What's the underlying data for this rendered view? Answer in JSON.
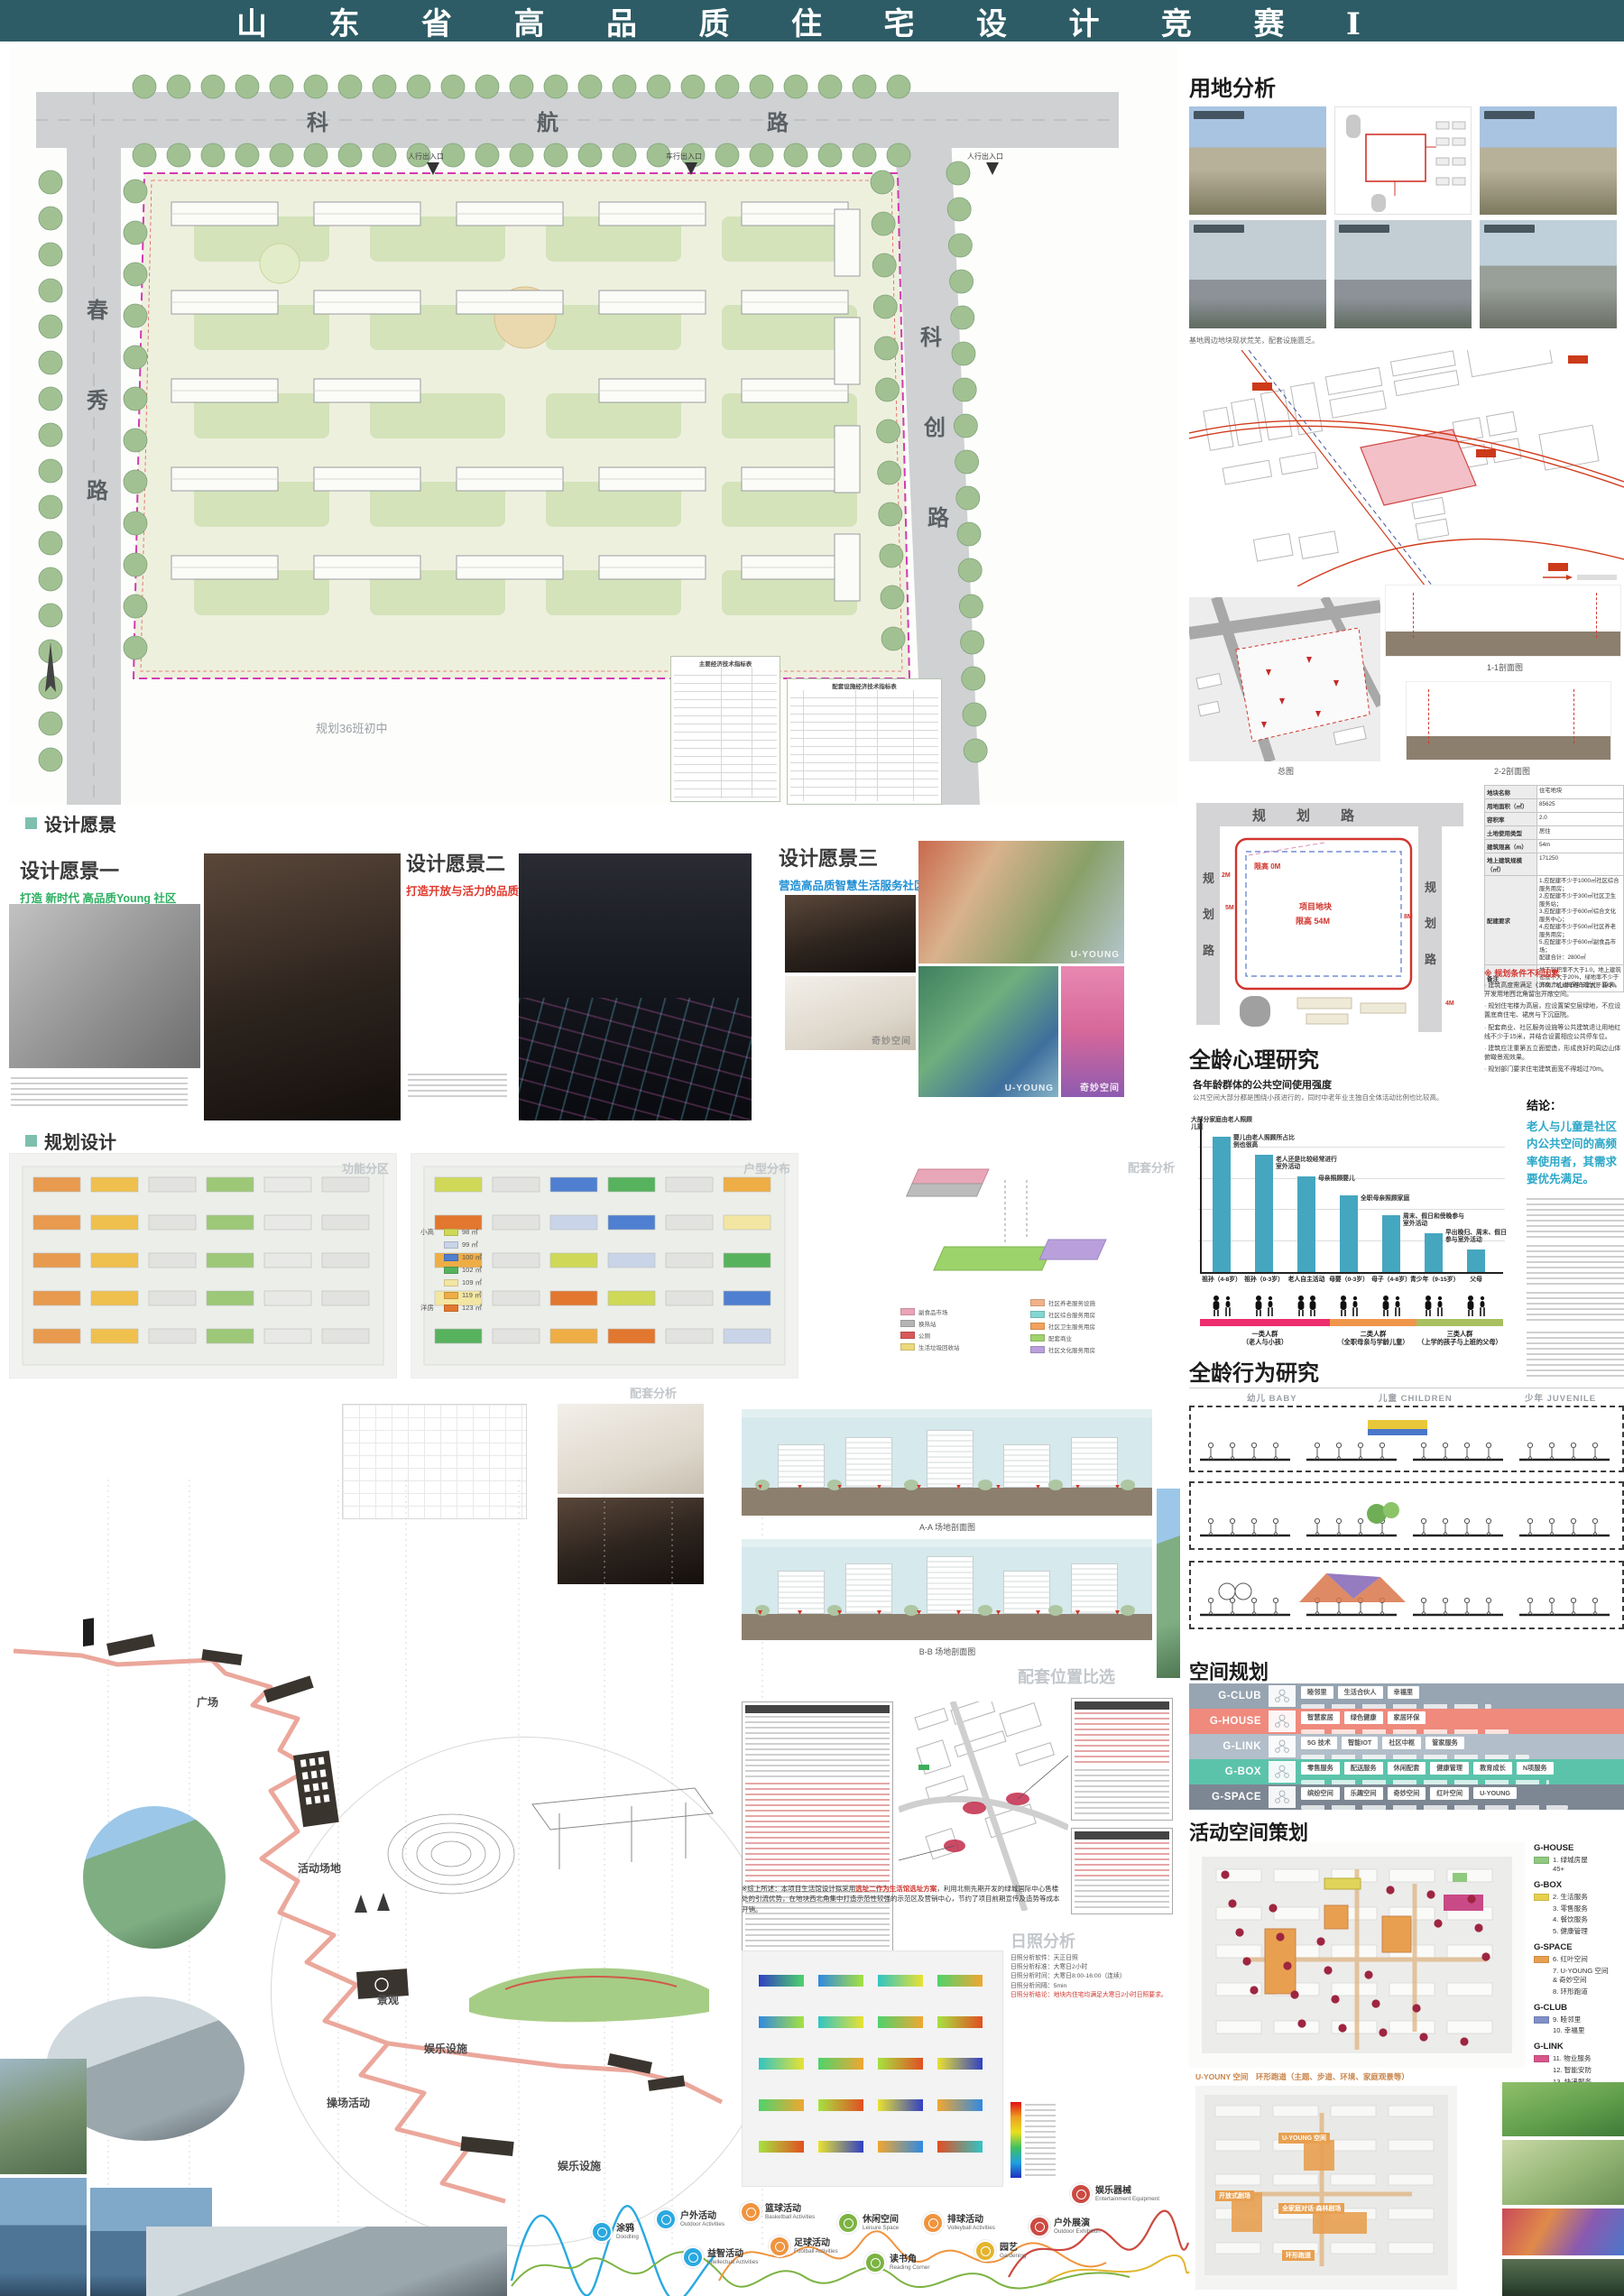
{
  "header": {
    "title": "山 东 省 高 品 质 住 宅 设 计 竞 赛 Ⅰ",
    "bar_color": "#2e5c66"
  },
  "masterplan": {
    "road_top": "科 航 路",
    "road_left": "春秀路",
    "road_right": "科创路",
    "note": "规划36班初中",
    "entries": [
      "人行出入口",
      "车行出入口·消防登高面出入口",
      "人行出入口"
    ],
    "boundary_color": "#d23bb0",
    "tables": [
      {
        "title": "主要经济技术指标表"
      },
      {
        "title": "配套设施经济技术指标表"
      }
    ]
  },
  "vision": {
    "header": "设计愿景",
    "accent": "#7fbfae",
    "items": [
      {
        "title": "设计愿景一",
        "subtitle": "打造 新时代 高品质Young 社区",
        "color": "#2eaf62"
      },
      {
        "title": "设计愿景二",
        "subtitle": "打造开放与活力的品质社区",
        "color": "#e0392e"
      },
      {
        "title": "设计愿景三",
        "subtitle": "营造高品质智慧生活服务社区",
        "color": "#1f8fd5"
      }
    ],
    "watermark_a": "U-YOUNG",
    "watermark_b": "奇妙空间"
  },
  "planning": {
    "header": "规划设计",
    "diagrams": [
      {
        "label": "功能分区"
      },
      {
        "label": "户型分布"
      },
      {
        "label": "配套分析"
      }
    ],
    "detail_label": "配套分析",
    "unit_legend": {
      "group_a": "小高",
      "group_b": "洋房",
      "items": [
        {
          "label": "98 ㎡",
          "color": "#cfd957"
        },
        {
          "label": "99 ㎡",
          "color": "#c9d4e8"
        },
        {
          "label": "100 ㎡",
          "color": "#4f7fd0"
        },
        {
          "label": "102 ㎡",
          "color": "#57b25e"
        },
        {
          "label": "109 ㎡",
          "color": "#f3e6a2"
        },
        {
          "label": "119 ㎡",
          "color": "#eead45"
        },
        {
          "label": "123 ㎡",
          "color": "#e2772f"
        }
      ]
    },
    "amenity_left": [
      {
        "label": "副食品市场",
        "color": "#e9a4b7"
      },
      {
        "label": "换热站",
        "color": "#b5b5b5"
      },
      {
        "label": "公厕",
        "color": "#d85a5a"
      },
      {
        "label": "生活垃圾回收站",
        "color": "#ecd97d"
      }
    ],
    "amenity_right": [
      {
        "label": "社区养老服务设施",
        "color": "#f2b289"
      },
      {
        "label": "社区综合服务用房",
        "color": "#84d6d2"
      },
      {
        "label": "社区卫生服务用房",
        "color": "#f2a25c"
      },
      {
        "label": "配套商业",
        "color": "#a0d36b"
      },
      {
        "label": "社区文化服务用房",
        "color": "#b9a0dc"
      }
    ],
    "journey": {
      "labels": [
        "广场",
        "活动场地",
        "景观",
        "娱乐设施",
        "操场活动",
        "娱乐设施",
        "活动场地"
      ],
      "side": [
        "服务设施",
        "体验互动",
        "休闲娱乐"
      ]
    },
    "sections": {
      "label": "竖向分析",
      "caption_a": "A-A 场地剖面图",
      "caption_b": "B-B 场地剖面图"
    },
    "siting": {
      "header": "配套位置比选",
      "note_pre": "※综上所述：本项目生活馆设计拟采用",
      "note_red": "选址二作为生活馆选址方案",
      "note_post": "，利用北侧先期开发的绿城国际中心售楼处的引流优势，在地块西北角集中打造示范性较强的示范区及营销中心，节约了项目前期宣传及造势等成本开销。"
    },
    "sunshine": {
      "header": "日照分析",
      "params": [
        "日照分析软件：天正日照",
        "日照分析标准：大寒日2小时",
        "日照分析时间：大寒日8:00-16:00（连续）",
        "日照分析间隔：5min",
        "日照分析结论：地块内住宅均满足大寒日2小时日照要求。"
      ]
    },
    "activities": [
      {
        "zh": "涂鸦",
        "en": "Doodling",
        "color": "#2aa9e0"
      },
      {
        "zh": "户外活动",
        "en": "Outdoor Activities",
        "color": "#2aa9e0"
      },
      {
        "zh": "益智活动",
        "en": "Intellectual Activities",
        "color": "#2aa9e0"
      },
      {
        "zh": "篮球活动",
        "en": "Basketball Activities",
        "color": "#f0943f"
      },
      {
        "zh": "足球活动",
        "en": "Football Activities",
        "color": "#f0943f"
      },
      {
        "zh": "休闲空间",
        "en": "Leisure Space",
        "color": "#7cb342"
      },
      {
        "zh": "读书角",
        "en": "Reading Corner",
        "color": "#7cb342"
      },
      {
        "zh": "排球活动",
        "en": "Volleyball Activities",
        "color": "#f0943f"
      },
      {
        "zh": "园艺",
        "en": "Gardening",
        "color": "#e3b52e"
      },
      {
        "zh": "户外展演",
        "en": "Outdoor Exhibition",
        "color": "#cc4a41"
      },
      {
        "zh": "娱乐器械",
        "en": "Entertainment Equipment",
        "color": "#cc4a41"
      }
    ]
  },
  "site_analysis": {
    "header": "用地分析",
    "caption": "基地周边地块现状荒芜，配套设施匮乏。",
    "map_caption": "总图",
    "section_a": "1-1剖面图",
    "section_b": "2-2剖面图"
  },
  "conditions": {
    "road_label": "规划路",
    "site_line1": "项目地块",
    "site_line2": "限高 54M",
    "height_note": "限高 0M",
    "dims": [
      "2M",
      "5M",
      "8M",
      "4M"
    ],
    "table": [
      {
        "k": "地块名称",
        "v": "住宅地块"
      },
      {
        "k": "用地面积（㎡）",
        "v": "85625"
      },
      {
        "k": "容积率",
        "v": "2.0"
      },
      {
        "k": "土地使用类型",
        "v": "居住"
      },
      {
        "k": "建筑限高（m）",
        "v": "54m"
      },
      {
        "k": "地上建筑规模（㎡）",
        "v": "171250"
      },
      {
        "k": "配建要求",
        "v": "1.应配建不少于1000㎡社区综合服务用房；\n2.应配建不少于300㎡社区卫生服务站；\n3.应配建不少于600㎡综合文化服务中心；\n4.应配建不少于500㎡社区养老服务用房；\n5.应配建不少于600㎡副食品市场；\n配建合计：2800㎡"
      },
      {
        "k": "备注",
        "v": "地下容积率不大于1.0，地上建筑密度不大于20%，绿地率不少于35%，机动车停车率大于100%"
      }
    ],
    "issues_header": "※ 规划条件不利因素",
    "issues": [
      "建筑高度需满足《济南市山体保护规划》要求，开发用地西北角留出开敞空间。",
      "规划住宅楼为高层，应设置架空层绿地，不应设置底商住宅、裙房与下沉庭院。",
      "配套商业、社区服务设施等公共建筑退让用地红线不少于15米，并结合设置相应公共停车位。",
      "建筑应注重第五立面塑造，形成良好的周边山体俯瞰景观效果。",
      "规划部门要求住宅建筑面宽不得超过70m。"
    ]
  },
  "psychology": {
    "header": "全龄心理研究",
    "subtitle": "各年龄群体的公共空间使用强度",
    "desc": "公共空间大部分都是围绕小孩进行的，同时中老年业主独自全体活动比例也比较高。",
    "conclusion_title": "结论：",
    "conclusion": "老人与儿童是社区内公共空间的高频率使用者，其需求要优先满足。",
    "conclusion_color": "#2ba8c8"
  },
  "chart_data": {
    "type": "bar",
    "title": "各年龄群体的公共空间使用强度",
    "categories": [
      "祖孙（4-8岁）",
      "祖孙（0-3岁）",
      "老人自主活动",
      "母婴（0-3岁）",
      "母子（4-8岁）",
      "青少年（9-15岁）",
      "父母"
    ],
    "values": [
      0.95,
      0.82,
      0.67,
      0.54,
      0.4,
      0.27,
      0.16
    ],
    "annotations": [
      "大部分家庭由老人照顾儿童",
      "婴儿由老人照顾所占比例也很高",
      "老人还是比较经常进行室外活动",
      "母亲照顾婴儿",
      "全职母亲照顾家庭",
      "周末、假日和傍晚参与室外活动",
      "早出晚归、周末、假日参与室外活动"
    ],
    "bar_color": "#45a6bf",
    "ylim": [
      0,
      1
    ],
    "grid": true,
    "legend_position": "none",
    "groups": [
      {
        "label": "一类人群\n（老人与小孩）",
        "color": "#ee2d6f",
        "bars": 3
      },
      {
        "label": "二类人群\n（全职母亲与学龄儿童）",
        "color": "#f0964b",
        "bars": 2
      },
      {
        "label": "三类人群\n（上学的孩子与上班的父母）",
        "color": "#a8c05f",
        "bars": 2
      }
    ]
  },
  "behavior": {
    "header": "全龄行为研究",
    "columns": [
      "幼儿 BABY",
      "儿童 CHILDREN",
      "少年 JUVENILE"
    ]
  },
  "space_plan": {
    "header": "空间规划",
    "bands": [
      {
        "name": "G-CLUB",
        "color": "#97a4b1",
        "chips": [
          "睦邻里",
          "生活合伙人",
          "幸福里"
        ]
      },
      {
        "name": "G-HOUSE",
        "color": "#ef8a7d",
        "chips": [
          "智慧家居",
          "绿色健康",
          "家居环保"
        ]
      },
      {
        "name": "G-LINK",
        "color": "#b2bec9",
        "chips": [
          "5G 技术",
          "智能IOT",
          "社区中枢",
          "管家服务"
        ]
      },
      {
        "name": "G-BOX",
        "color": "#5cc3ab",
        "chips": [
          "零售服务",
          "配送服务",
          "休闲配套",
          "健康管理",
          "教育成长",
          "N项服务"
        ]
      },
      {
        "name": "G-SPACE",
        "color": "#7d8793",
        "chips": [
          "缤纷空间",
          "乐趣空间",
          "奇妙空间",
          "红叶空间",
          "U-YOUNG"
        ]
      }
    ]
  },
  "activity_plan": {
    "header": "活动空间策划",
    "legend": [
      {
        "group": "G-HOUSE",
        "color": "#8fc97e",
        "items": [
          "1. 绿城房屋\n    45+"
        ]
      },
      {
        "group": "G-BOX",
        "color": "#e8d04e",
        "items": [
          "2. 生活服务",
          "3. 零售服务",
          "4. 餐饮服务",
          "5. 健康管理"
        ]
      },
      {
        "group": "G-SPACE",
        "color": "#e8a050",
        "items": [
          "6. 红叶空间",
          "7. U-YOUNG 空间\n    & 奇妙空间",
          "8. 环形跑道"
        ]
      },
      {
        "group": "G-CLUB",
        "color": "#8090c8",
        "items": [
          "9. 睦邻里",
          "10. 幸福里"
        ]
      },
      {
        "group": "G-LINK",
        "color": "#d8558a",
        "items": [
          "11. 物业服务",
          "12. 智能安防",
          "13. 快递服务",
          "14. 垃圾点"
        ]
      }
    ],
    "caption": "U-YOUNY 空间　环形跑道（主题、步道、环境、家庭观景等）",
    "plan_labels": [
      "U-YOUNG 空间",
      "开放式剧场",
      "全家庭对话·森林剧场",
      "环形跑道"
    ]
  }
}
